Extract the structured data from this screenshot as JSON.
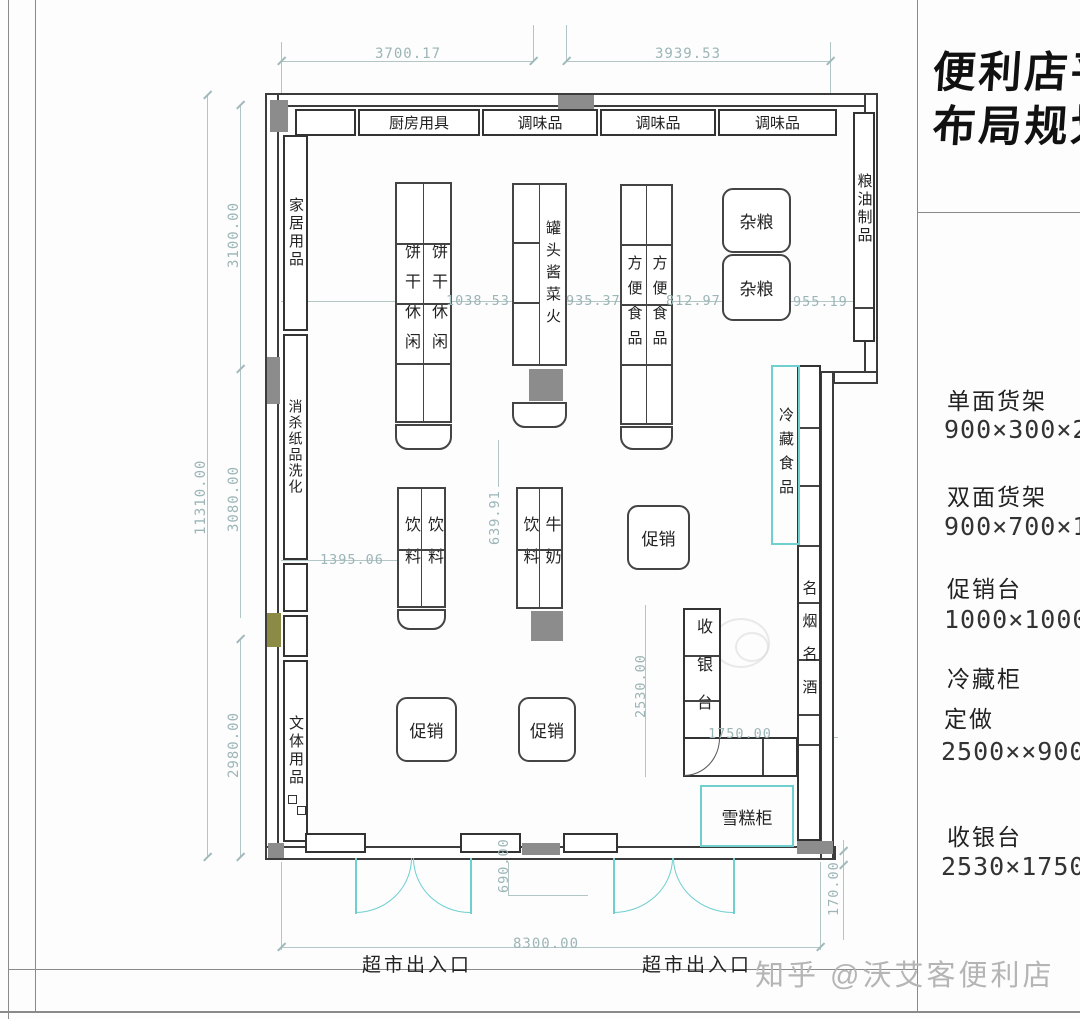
{
  "title": {
    "line1": "便利店平",
    "line2": "布局规划"
  },
  "legend": {
    "items": [
      {
        "name": "单面货架",
        "size": "900×300×20"
      },
      {
        "name": "双面货架",
        "size": "900×700×16"
      },
      {
        "name": "促销台",
        "size": "1000×1000×8"
      },
      {
        "name": "冷藏柜",
        "note": "定做",
        "size": "2500××900×"
      },
      {
        "name": "收银台",
        "size": "2530×1750×8"
      }
    ]
  },
  "plan": {
    "top_shelves": [
      "厨房用具",
      "调味品",
      "调味品",
      "调味品"
    ],
    "left_shelves": [
      "家居用品",
      "消杀纸品洗化",
      "文体用品"
    ],
    "right_shelves": {
      "grain_oil": "粮油制品",
      "cold_food": "冷藏食品",
      "tobacco_liquor": "名烟名酒"
    },
    "gondolas": {
      "biscuits": [
        "饼干休闲",
        "饼干休闲"
      ],
      "canned": "罐头酱菜火",
      "instant": [
        "方便食品",
        "方便食品"
      ],
      "grains": [
        "杂粮",
        "杂粮"
      ],
      "drinks": [
        "饮料",
        "饮料"
      ],
      "drinks_milk": [
        "饮料",
        "牛奶"
      ],
      "promo": "促销",
      "cashier": "收银台",
      "ice_cream": "雪糕柜"
    },
    "entrance_label": "超市出入口"
  },
  "dimensions": {
    "top_left": "3700.17",
    "top_right": "3939.53",
    "left_total": "11310.00",
    "left_seg1": "3100.00",
    "left_seg2": "3080.00",
    "left_seg3": "2980.00",
    "aisle1": "1038.53",
    "aisle2": "935.37",
    "aisle3": "812.97",
    "aisle4": "955.19",
    "aisle5": "1395.06",
    "aisle6": "639.91",
    "cashier_depth": "2530.00",
    "cashier_width": "1750.00",
    "bottom_width": "8300.00",
    "door_offset": "690.00",
    "right_step": "170.00"
  },
  "watermark": "知乎 @沃艾客便利店",
  "colors": {
    "wall": "#3c3c3c",
    "dim": "#9cb5b7",
    "accent_cyan": "#6fcfcf",
    "block_gray": "#8c8c8c",
    "block_olive": "#8b8b45",
    "watermark_gray": "#b5b5b5"
  }
}
